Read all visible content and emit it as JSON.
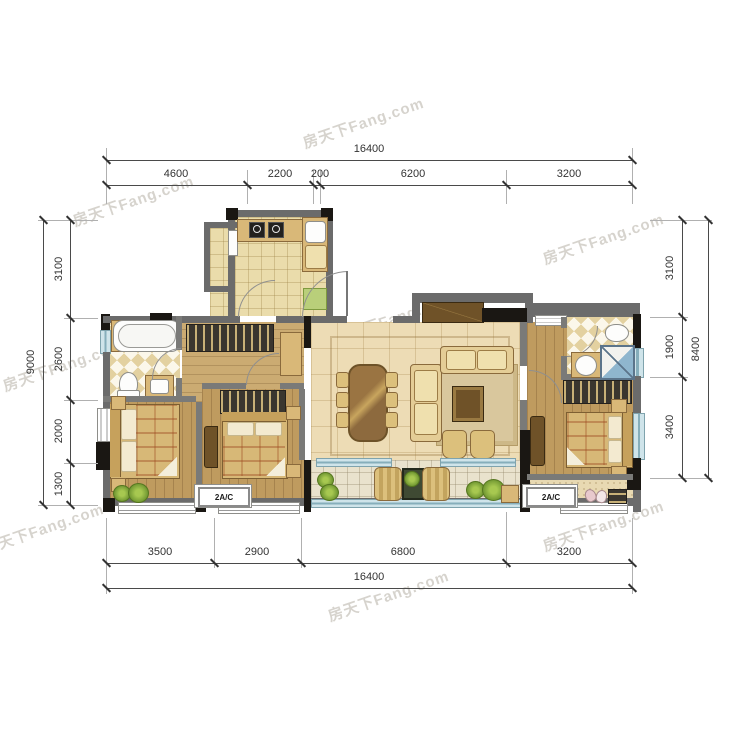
{
  "watermark": {
    "text": "房天下Fang.com"
  },
  "dimensions": {
    "top": {
      "total": "16400",
      "segments": [
        "4600",
        "2200",
        "200",
        "6200",
        "3200"
      ]
    },
    "bottom": {
      "total": "16400",
      "segments": [
        "3500",
        "2900",
        "6800",
        "3200"
      ]
    },
    "left": {
      "total": "9000",
      "segments": [
        "3100",
        "2600",
        "2000",
        "1300"
      ]
    },
    "right": {
      "total": "8400",
      "segments": [
        "3100",
        "1900",
        "3400"
      ]
    }
  },
  "labels": {
    "ac_unit_left": "2A/C",
    "ac_unit_right": "2A/C"
  },
  "colors": {
    "wall_gray": "#6b6b6b",
    "structure_black": "#1a1713",
    "wood_floor": "#bf9b5f",
    "tile_floor": "#eadcab",
    "living_floor": "#eddcb5",
    "balcony_floor": "#e9e2cd",
    "bath_checker": "#e3d1a0",
    "window_glass": "#86aebb",
    "furniture_tan": "#d9b878",
    "furniture_dark_wood": "#6f5228",
    "plant_green": "#6d9430",
    "dimension_text": "#333333",
    "watermark_gray": "#bab5ad"
  }
}
